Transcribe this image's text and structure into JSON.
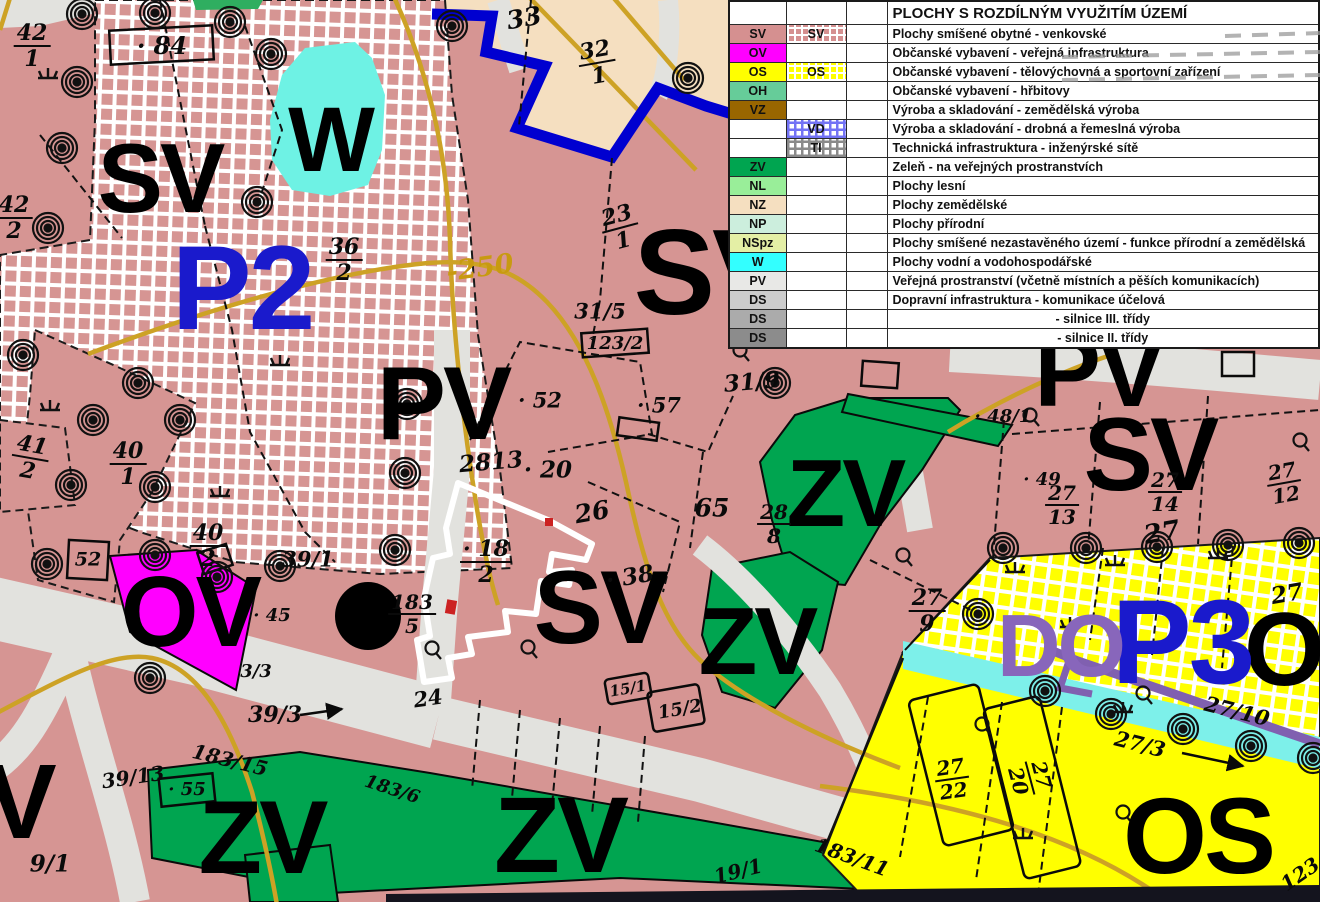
{
  "legend": {
    "title": "PLOCHY S ROZDÍLNÝM VYUŽITÍM ÚZEMÍ",
    "rows": [
      {
        "code": "SV",
        "code_bg": "#d59090",
        "swatch": "h-pink",
        "swatch_label": "SV",
        "desc": "Plochy smíšené obytné - venkovské"
      },
      {
        "code": "OV",
        "code_bg": "#ff00ff",
        "swatch": "",
        "swatch_label": "",
        "desc": "Občanské vybavení - veřejná infrastruktura"
      },
      {
        "code": "OS",
        "code_bg": "#ffff00",
        "swatch": "h-yellow",
        "swatch_label": "OS",
        "desc": "Občanské vybavení - tělovýchovná a sportovní zařízení"
      },
      {
        "code": "OH",
        "code_bg": "#66cc99",
        "swatch": "",
        "swatch_label": "",
        "desc": "Občanské vybavení - hřbitovy"
      },
      {
        "code": "VZ",
        "code_bg": "#996600",
        "swatch": "",
        "swatch_label": "",
        "desc": "Výroba a skladování - zemědělská výroba"
      },
      {
        "code": "",
        "code_bg": "#ffffff",
        "swatch": "h-blue",
        "swatch_label": "VD",
        "desc": "Výroba a skladování - drobná a řemeslná výroba"
      },
      {
        "code": "",
        "code_bg": "#ffffff",
        "swatch": "h-gray",
        "swatch_label": "TI",
        "desc": "Technická infrastruktura - inženýrské sítě"
      },
      {
        "code": "ZV",
        "code_bg": "#00a550",
        "swatch": "",
        "swatch_label": "",
        "desc": "Zeleň - na veřejných prostranstvích"
      },
      {
        "code": "NL",
        "code_bg": "#99ee99",
        "swatch": "",
        "swatch_label": "",
        "desc": "Plochy lesní"
      },
      {
        "code": "NZ",
        "code_bg": "#f5dfc0",
        "swatch": "",
        "swatch_label": "",
        "desc": "Plochy zemědělské"
      },
      {
        "code": "NP",
        "code_bg": "#cceedd",
        "swatch": "",
        "swatch_label": "",
        "desc": "Plochy přírodní"
      },
      {
        "code": "NSpz",
        "code_bg": "#e4efa5",
        "swatch": "",
        "swatch_label": "",
        "desc": "Plochy smíšené nezastavěného území - funkce přírodní a zemědělská"
      },
      {
        "code": "W",
        "code_bg": "#33ffff",
        "swatch": "",
        "swatch_label": "",
        "desc": "Plochy vodní a vodohospodářské"
      },
      {
        "code": "PV",
        "code_bg": "#e8e8e6",
        "swatch": "",
        "swatch_label": "",
        "desc": "Veřejná prostranství (včetně místních a pěších komunikacích)"
      },
      {
        "code": "DS",
        "code_bg": "#cccccc",
        "swatch": "",
        "swatch_label": "",
        "desc": "Dopravní infrastruktura - komunikace účelová"
      },
      {
        "code": "DS",
        "code_bg": "#ababab",
        "swatch": "",
        "swatch_label": "",
        "desc": "- silnice III. třídy",
        "center": true
      },
      {
        "code": "DS",
        "code_bg": "#8c8c8c",
        "swatch": "",
        "swatch_label": "",
        "desc": "- silnice II. třídy",
        "center": true
      }
    ]
  },
  "map": {
    "colors": {
      "sv_pink": "#d69593",
      "ov_magenta": "#ff00ff",
      "os_yellow": "#ffff00",
      "zv_green": "#00a550",
      "w_cyan": "#6ef2e4",
      "nz_tan": "#f5dfc0",
      "road_gray": "#e2e2de",
      "boundary_blue": "#0000d0",
      "plan_blue": "#1a1acc",
      "do_purple": "#8866bb",
      "contour_ochre": "#cda225"
    },
    "labels": [
      {
        "t": "SV",
        "f": "zone",
        "x": 160,
        "y": 178,
        "s": 98
      },
      {
        "t": "W",
        "f": "zone",
        "x": 330,
        "y": 140,
        "s": 92
      },
      {
        "t": "P2",
        "f": "zone",
        "x": 242,
        "y": 288,
        "s": 120,
        "c": "#1a1acc"
      },
      {
        "t": "SV",
        "f": "zone",
        "x": 712,
        "y": 272,
        "s": 122
      },
      {
        "t": "PV",
        "f": "zone",
        "x": 443,
        "y": 404,
        "s": 104
      },
      {
        "t": "SV",
        "f": "zone",
        "x": 600,
        "y": 608,
        "s": 104
      },
      {
        "t": "ZV",
        "f": "zone",
        "x": 845,
        "y": 494,
        "s": 96
      },
      {
        "t": "ZV",
        "f": "zone",
        "x": 757,
        "y": 642,
        "s": 96
      },
      {
        "t": "PV",
        "f": "zone",
        "x": 1098,
        "y": 372,
        "s": 100
      },
      {
        "t": "SV",
        "f": "zone",
        "x": 1150,
        "y": 455,
        "s": 104
      },
      {
        "t": "OV",
        "f": "zone",
        "x": 190,
        "y": 612,
        "s": 100
      },
      {
        "t": "ZV",
        "f": "zone",
        "x": 262,
        "y": 838,
        "s": 104
      },
      {
        "t": "ZV",
        "f": "zone",
        "x": 560,
        "y": 835,
        "s": 108
      },
      {
        "t": "OS",
        "f": "zone",
        "x": 1198,
        "y": 836,
        "s": 108
      },
      {
        "t": "O",
        "f": "zone",
        "x": 1283,
        "y": 650,
        "s": 104
      },
      {
        "t": "P3",
        "f": "zone",
        "x": 1182,
        "y": 642,
        "s": 120,
        "c": "#1a1acc"
      },
      {
        "t": "DO",
        "f": "zone",
        "x": 1060,
        "y": 646,
        "s": 88,
        "c": "#8866bb"
      },
      {
        "t": "SV",
        "f": "zone",
        "x": -14,
        "y": 802,
        "s": 106
      },
      {
        "t": "-250",
        "f": "num",
        "x": 480,
        "y": 268,
        "s": 27,
        "c": "#c89a10",
        "r": -8
      },
      {
        "t": "· 84",
        "x": 162,
        "y": 46,
        "s": 24
      },
      {
        "t": "33",
        "x": 524,
        "y": 18,
        "s": 25,
        "r": -10
      },
      {
        "t": "· 57",
        "x": 874,
        "y": 226,
        "s": 21
      },
      {
        "t": "31/5",
        "x": 600,
        "y": 311,
        "s": 21
      },
      {
        "t": "123/2",
        "x": 615,
        "y": 344,
        "s": 18
      },
      {
        "t": "31/9",
        "x": 752,
        "y": 382,
        "s": 23,
        "r": -5
      },
      {
        "t": "· 52",
        "x": 540,
        "y": 400,
        "s": 21
      },
      {
        "t": "· 57",
        "x": 659,
        "y": 405,
        "s": 21
      },
      {
        "t": "2813",
        "x": 491,
        "y": 462,
        "s": 23,
        "r": -5
      },
      {
        "t": "· 20",
        "x": 548,
        "y": 470,
        "s": 23
      },
      {
        "t": "26",
        "x": 592,
        "y": 512,
        "s": 25,
        "r": -10
      },
      {
        "t": "· 38",
        "x": 630,
        "y": 577,
        "s": 23,
        "r": -10
      },
      {
        "t": "65",
        "x": 712,
        "y": 508,
        "s": 25
      },
      {
        "t": "· 48/1",
        "x": 1003,
        "y": 417,
        "s": 18
      },
      {
        "t": "· 49",
        "x": 1042,
        "y": 480,
        "s": 18
      },
      {
        "t": "27",
        "x": 1162,
        "y": 533,
        "s": 26,
        "r": -10
      },
      {
        "t": "27",
        "x": 1287,
        "y": 594,
        "s": 23,
        "r": -10
      },
      {
        "t": "39/1",
        "x": 308,
        "y": 559,
        "s": 21
      },
      {
        "t": "39/3",
        "x": 275,
        "y": 715,
        "s": 22
      },
      {
        "t": "39/13",
        "x": 133,
        "y": 777,
        "s": 20,
        "r": -8
      },
      {
        "t": "183/15",
        "x": 230,
        "y": 760,
        "s": 20,
        "r": 14
      },
      {
        "t": "· 45",
        "x": 272,
        "y": 616,
        "s": 18
      },
      {
        "t": "3/3",
        "x": 256,
        "y": 672,
        "s": 18
      },
      {
        "t": "· 55",
        "x": 187,
        "y": 790,
        "s": 18
      },
      {
        "t": "24",
        "x": 428,
        "y": 698,
        "s": 21,
        "r": -8
      },
      {
        "t": "15/1",
        "x": 628,
        "y": 689,
        "s": 15,
        "r": -10
      },
      {
        "t": "15/2",
        "x": 680,
        "y": 710,
        "s": 18,
        "r": -10
      },
      {
        "t": "19/1",
        "x": 738,
        "y": 871,
        "s": 20,
        "r": -14
      },
      {
        "t": "183/6",
        "x": 392,
        "y": 790,
        "s": 18,
        "r": 18
      },
      {
        "t": "183/11",
        "x": 852,
        "y": 857,
        "s": 20,
        "r": 20
      },
      {
        "t": "27/10",
        "x": 1237,
        "y": 711,
        "s": 21,
        "r": 14
      },
      {
        "t": "27/3",
        "x": 1140,
        "y": 744,
        "s": 21,
        "r": 14
      },
      {
        "t": "123",
        "x": 1300,
        "y": 874,
        "s": 20,
        "r": -35
      },
      {
        "t": "9/1",
        "x": 50,
        "y": 864,
        "s": 23
      },
      {
        "t": "52",
        "x": 88,
        "y": 560,
        "s": 19
      },
      {
        "n": "42",
        "d": "1",
        "x": 32,
        "y": 46,
        "s": 22
      },
      {
        "n": "42",
        "d": "2",
        "x": 14,
        "y": 218,
        "s": 22
      },
      {
        "n": "41",
        "d": "2",
        "x": 30,
        "y": 458,
        "s": 22,
        "r": 10
      },
      {
        "n": "40",
        "d": "1",
        "x": 128,
        "y": 464,
        "s": 22
      },
      {
        "n": "40",
        "d": "2",
        "x": 208,
        "y": 546,
        "s": 22
      },
      {
        "n": "36",
        "d": "2",
        "x": 344,
        "y": 260,
        "s": 22
      },
      {
        "n": "32",
        "d": "1",
        "x": 597,
        "y": 63,
        "s": 22,
        "r": -10
      },
      {
        "n": "23",
        "d": "1",
        "x": 620,
        "y": 228,
        "s": 22,
        "r": -15
      },
      {
        "n": "· 18",
        "d": "2",
        "x": 486,
        "y": 562,
        "s": 22
      },
      {
        "n": "28",
        "d": "8",
        "x": 774,
        "y": 524,
        "s": 20
      },
      {
        "n": "27",
        "d": "9",
        "x": 927,
        "y": 611,
        "s": 22
      },
      {
        "n": "183",
        "d": "5",
        "x": 412,
        "y": 614,
        "s": 20
      },
      {
        "n": "27",
        "d": "13",
        "x": 1062,
        "y": 505,
        "s": 20
      },
      {
        "n": "27",
        "d": "14",
        "x": 1165,
        "y": 492,
        "s": 20
      },
      {
        "n": "27",
        "d": "12",
        "x": 1284,
        "y": 483,
        "s": 20,
        "r": -10
      },
      {
        "n": "27",
        "d": "22",
        "x": 952,
        "y": 779,
        "s": 20,
        "r": -8
      },
      {
        "n": "27",
        "d": "20",
        "x": 1030,
        "y": 778,
        "s": 20,
        "r": 75
      }
    ]
  },
  "symbols": {
    "spirals": [
      [
        82,
        14
      ],
      [
        155,
        13
      ],
      [
        230,
        22
      ],
      [
        271,
        54
      ],
      [
        77,
        82
      ],
      [
        62,
        148
      ],
      [
        48,
        228
      ],
      [
        257,
        202
      ],
      [
        452,
        26
      ],
      [
        688,
        78
      ],
      [
        812,
        160
      ],
      [
        23,
        355
      ],
      [
        93,
        420
      ],
      [
        138,
        383
      ],
      [
        180,
        420
      ],
      [
        71,
        485
      ],
      [
        155,
        487
      ],
      [
        47,
        564
      ],
      [
        155,
        555
      ],
      [
        280,
        566
      ],
      [
        217,
        577
      ],
      [
        150,
        678
      ],
      [
        407,
        404
      ],
      [
        405,
        473
      ],
      [
        395,
        550
      ],
      [
        775,
        383
      ],
      [
        978,
        614
      ],
      [
        1003,
        548
      ],
      [
        1086,
        548
      ],
      [
        1157,
        547
      ],
      [
        1228,
        545
      ],
      [
        1299,
        543
      ],
      [
        1045,
        691
      ],
      [
        1111,
        714
      ],
      [
        1183,
        729
      ],
      [
        1251,
        746
      ],
      [
        1313,
        758
      ]
    ],
    "grass": [
      [
        48,
        78
      ],
      [
        280,
        365
      ],
      [
        50,
        410
      ],
      [
        220,
        496
      ],
      [
        1015,
        572
      ],
      [
        1070,
        627
      ],
      [
        1115,
        565
      ],
      [
        1218,
        558
      ],
      [
        1023,
        838
      ],
      [
        1123,
        712
      ]
    ],
    "survey": [
      [
        740,
        350
      ],
      [
        868,
        198
      ],
      [
        903,
        555
      ],
      [
        528,
        647
      ],
      [
        432,
        648
      ],
      [
        1030,
        415
      ],
      [
        1300,
        440
      ],
      [
        1143,
        693
      ],
      [
        982,
        724
      ],
      [
        1123,
        812
      ]
    ]
  }
}
